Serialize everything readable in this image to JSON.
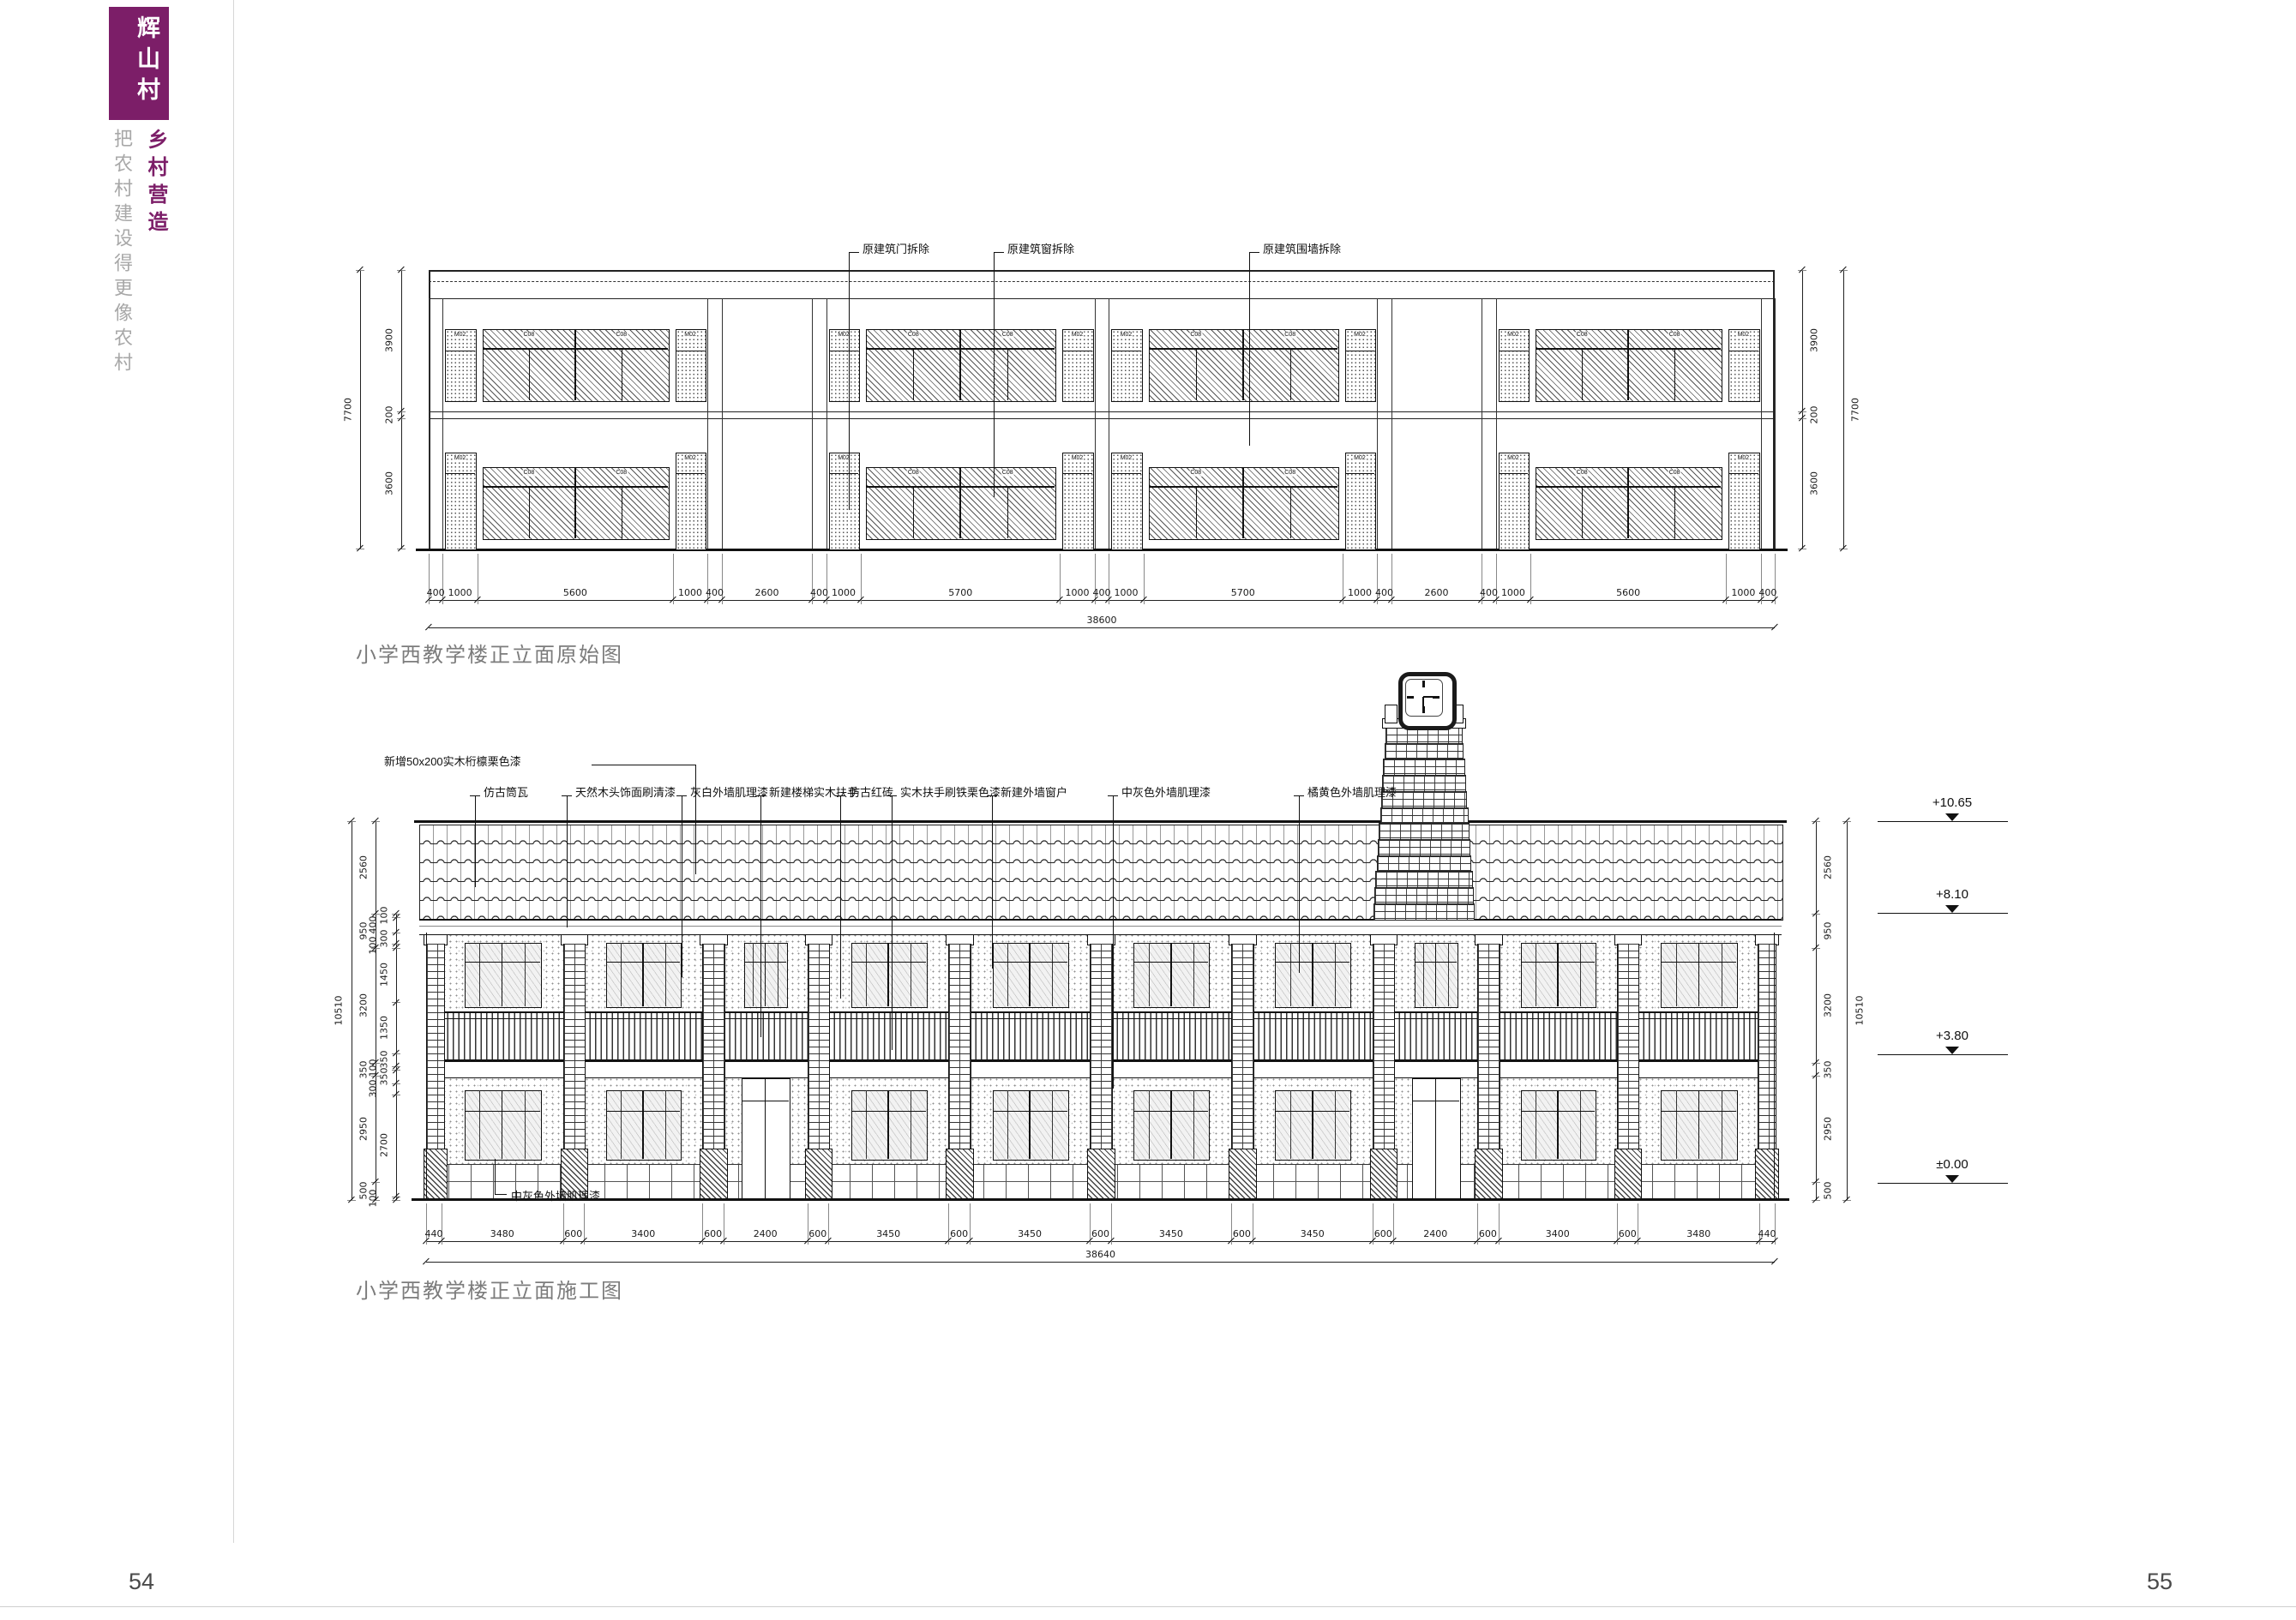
{
  "page": {
    "left_number": "54",
    "right_number": "55"
  },
  "sidebar": {
    "village_name": "辉山村",
    "series_title": "乡村营造",
    "tagline": "把农村建设得更像农村",
    "accent_color": "#7c1e68"
  },
  "original": {
    "caption": "小学西教学楼正立面原始图",
    "callouts": [
      "原建筑门拆除",
      "原建筑窗拆除",
      "原建筑围墙拆除"
    ],
    "door_code": "M02",
    "window_code": "C08",
    "h_segments": [
      400,
      1000,
      5600,
      1000,
      400,
      2600,
      400,
      1000,
      5700,
      1000,
      400,
      1000,
      5700,
      1000,
      400,
      2600,
      400,
      1000,
      5600,
      1000,
      400
    ],
    "h_total": "38600",
    "v_segments": [
      3900,
      200,
      3600
    ],
    "v_total": "7700"
  },
  "construction": {
    "caption": "小学西教学楼正立面施工图",
    "callouts": [
      "新增50x200实木桁檩栗色漆",
      "仿古筒瓦",
      "天然木头饰面刷清漆",
      "灰白外墙肌理漆",
      "新建楼梯实木扶手",
      "仿古红砖",
      "实木扶手刷铁栗色漆",
      "新建外墙窗户",
      "中灰色外墙肌理漆",
      "橘黄色外墙肌理漆"
    ],
    "callout_bottom": "中灰色外墙肌理漆",
    "h_segments": [
      440,
      3480,
      600,
      3400,
      600,
      2400,
      600,
      3450,
      600,
      3450,
      600,
      3450,
      600,
      3450,
      600,
      2400,
      600,
      3400,
      600,
      3480,
      440
    ],
    "h_total": "38640",
    "v_total": "10510",
    "v_mid": [
      2560,
      950,
      3200,
      350,
      2950,
      500
    ],
    "v_inner": [
      100,
      400,
      300,
      100,
      1450,
      1350,
      350,
      100,
      350,
      300,
      2700,
      100
    ],
    "elevations": [
      "+10.65",
      "+8.10",
      "+3.80",
      "±0.00"
    ]
  }
}
